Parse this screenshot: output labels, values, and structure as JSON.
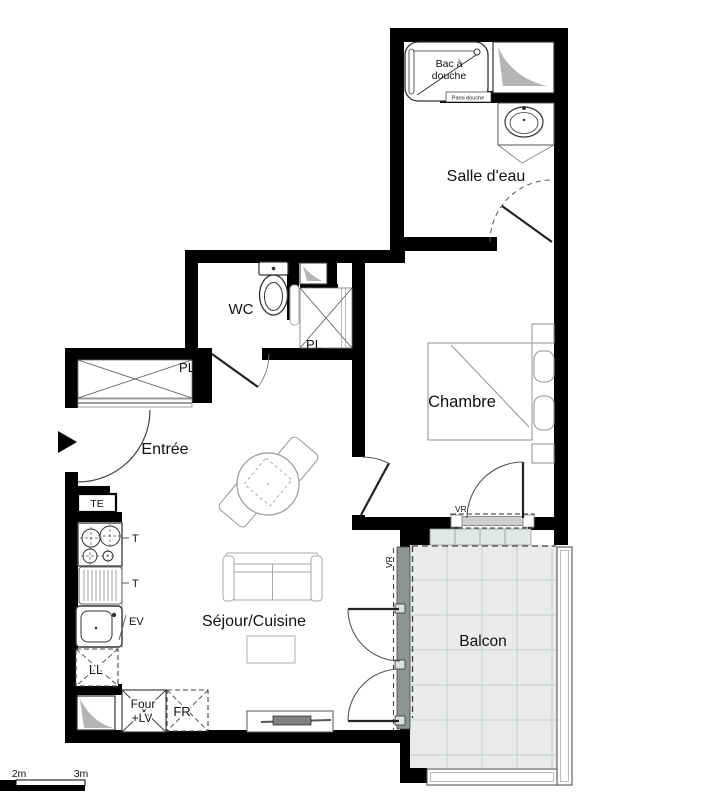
{
  "plan": {
    "type": "apartment-floor-plan",
    "rooms": {
      "salle_deau": "Salle d'eau",
      "wc": "WC",
      "chambre": "Chambre",
      "entree": "Entrée",
      "sejour_cuisine": "Séjour/Cuisine",
      "balcon": "Balcon"
    },
    "closets": {
      "pl_entree": "PL",
      "pl_chambre": "PL"
    },
    "fixtures": {
      "shower_line1": "Bac à",
      "shower_line2": "douche",
      "shower_screen": "Paroi douche",
      "electrical_panel": "TE",
      "counter_tick1": "T",
      "counter_tick2": "T",
      "kitchen_sink": "EV",
      "washing_machine": "LL",
      "oven_line1": "Four",
      "oven_line2": "+LV",
      "fridge": "FR",
      "shutter_chambre": "VR",
      "shutter_sejour": "VR"
    },
    "scale_bar": {
      "label_2m": "2m",
      "label_3m": "3m"
    },
    "colors": {
      "wall": "#000000",
      "balcony_tile": "#e9ebeb",
      "balcony_grid": "#c9cdcd",
      "duct_gray": "#b4b4b4",
      "furniture_line": "#999999",
      "text": "#111111"
    }
  }
}
